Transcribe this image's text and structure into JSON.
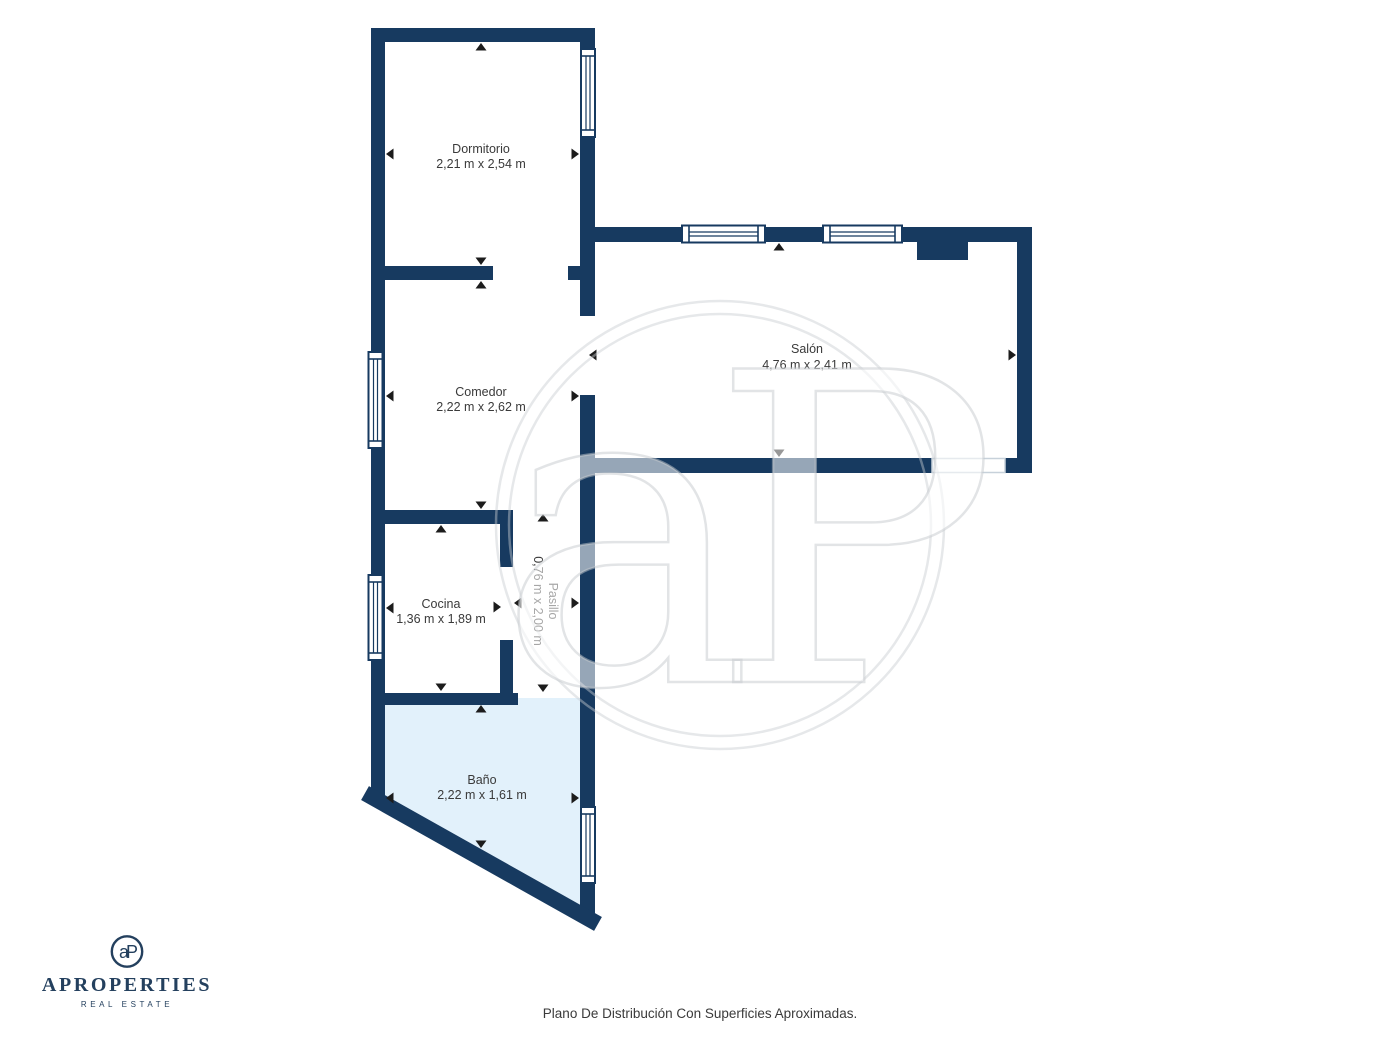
{
  "document": {
    "caption": "Plano De Distribución Con Superficies Aproximadas."
  },
  "branding": {
    "monogram": "aP",
    "name": "APROPERTIES",
    "tagline": "REAL ESTATE"
  },
  "watermark": {
    "monogram": "aP"
  },
  "palette": {
    "wall": "#173A60",
    "bath_floor": "#E2F1FB",
    "label_text": "#3A3A3A",
    "brand_navy": "#24405E"
  },
  "rooms": [
    {
      "id": "dormitorio",
      "name": "Dormitorio",
      "dims": "2,21 m x 2,54 m"
    },
    {
      "id": "comedor",
      "name": "Comedor",
      "dims": "2,22 m x 2,62 m"
    },
    {
      "id": "salon",
      "name": "Salón",
      "dims": "4,76 m x 2,41 m"
    },
    {
      "id": "cocina",
      "name": "Cocina",
      "dims": "1,36 m x 1,89 m"
    },
    {
      "id": "pasillo",
      "name": "Pasillo",
      "dims": "0,76 m x 2,00 m"
    },
    {
      "id": "bano",
      "name": "Baño",
      "dims": "2,22 m x 1,61 m"
    }
  ]
}
